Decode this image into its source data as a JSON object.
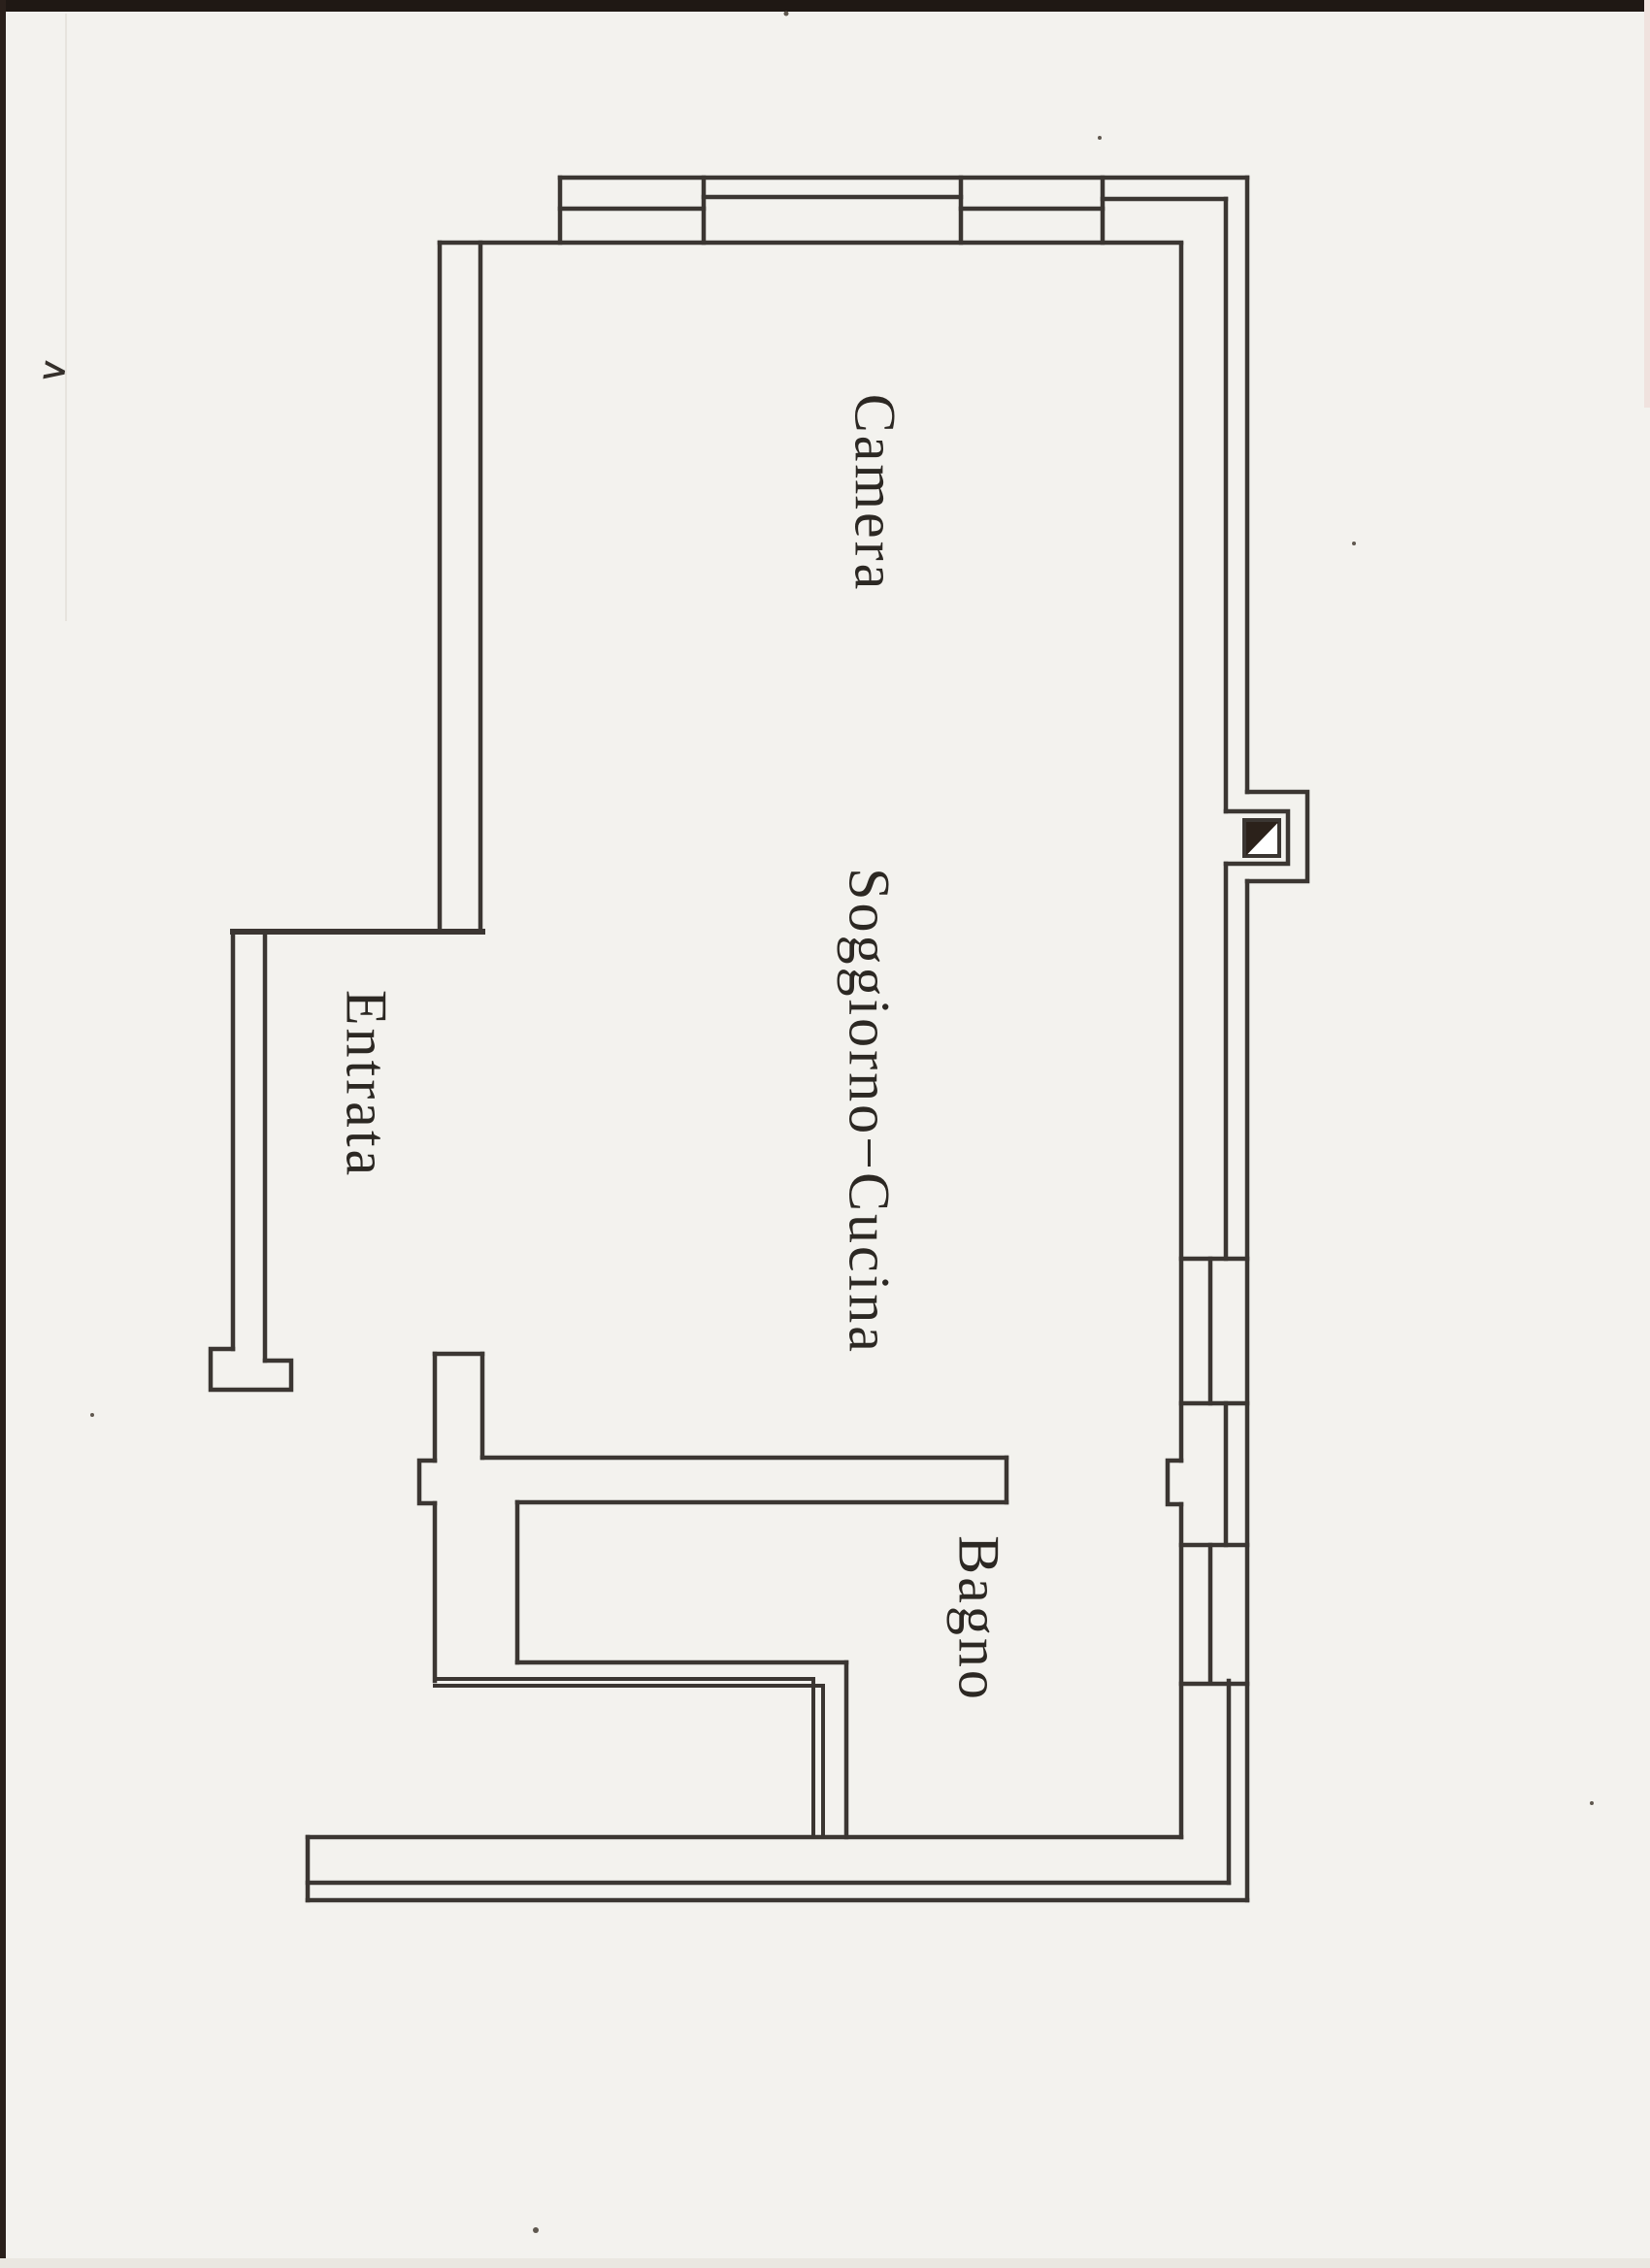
{
  "document": {
    "kind": "scanned floor plan",
    "language": "Italian"
  },
  "colors": {
    "paper": "#f3f2ee",
    "ink": "#3b3632",
    "label": "#2c2823",
    "scan_edge": "#1f1814",
    "column_fill": "#2b211a"
  },
  "rooms": [
    {
      "id": "camera",
      "label": "Camera"
    },
    {
      "id": "soggiorno-cucina",
      "label": "Soggiorno−Cucina"
    },
    {
      "id": "entrata",
      "label": "Entrata"
    },
    {
      "id": "bagno",
      "label": "Bagno"
    }
  ],
  "artifacts": {
    "corner_mark": ">"
  }
}
